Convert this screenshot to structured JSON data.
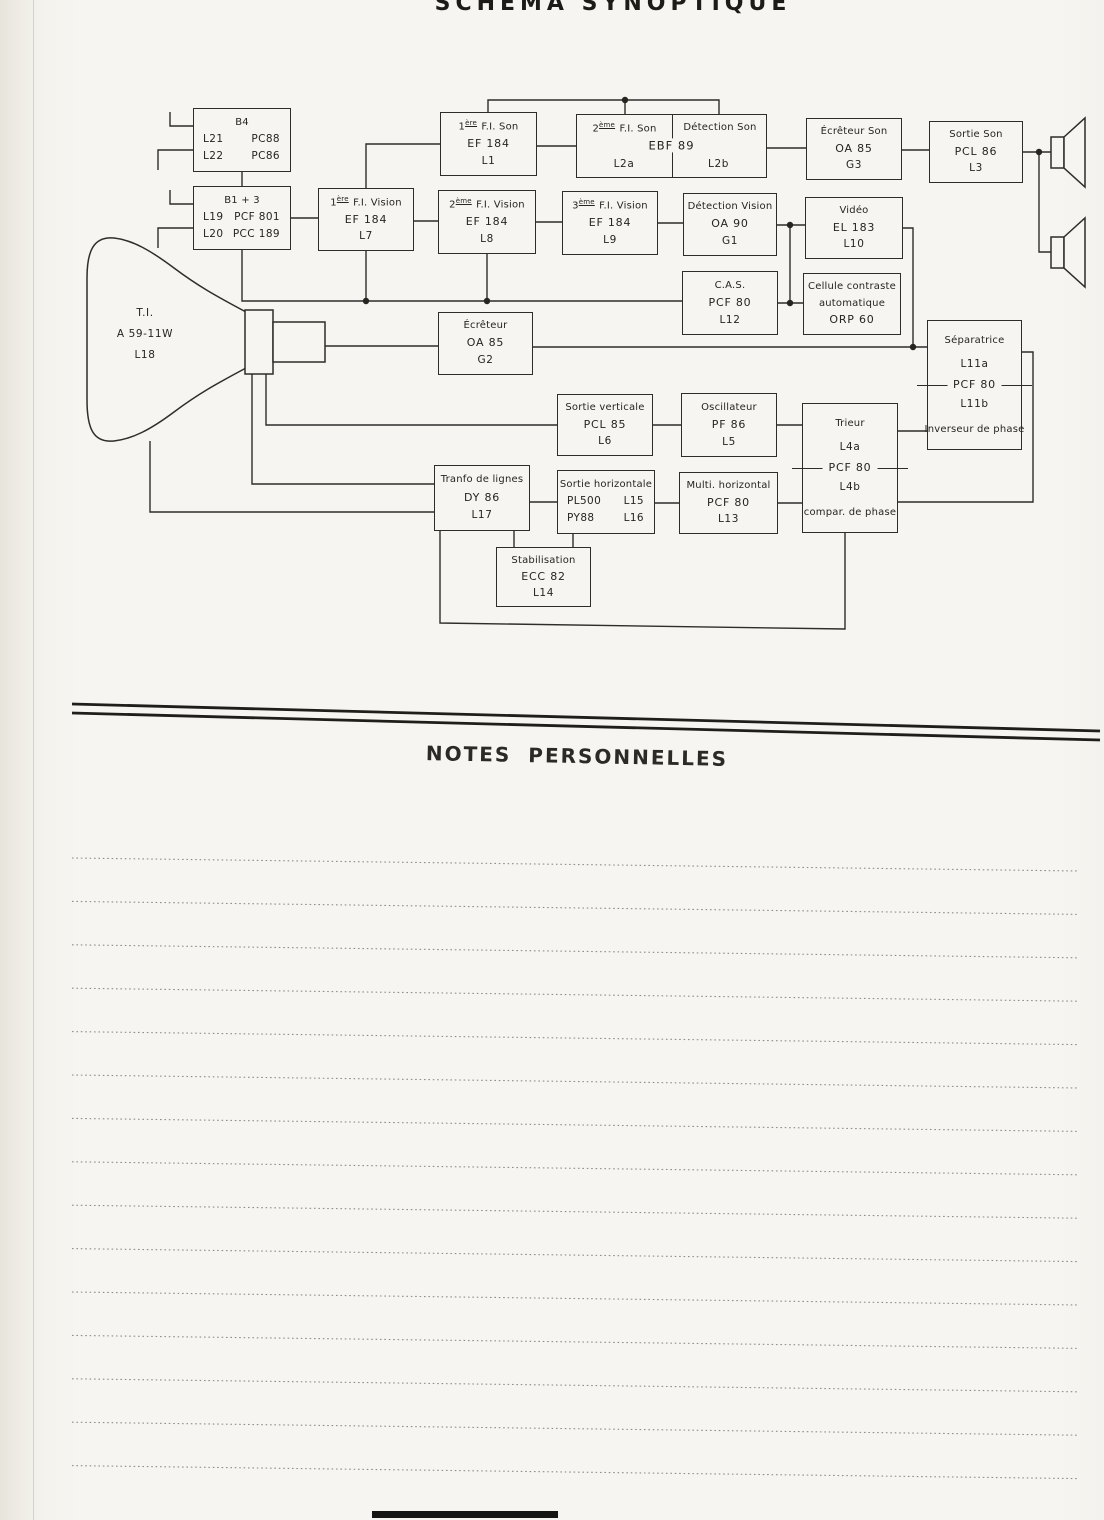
{
  "page": {
    "title": "SCHÉMA SYNOPTIQUE",
    "notes_heading": "NOTES PERSONNELLES"
  },
  "blocks": {
    "tuner_b4": {
      "title": "B4",
      "rows": [
        {
          "l": "L21",
          "r": "PC88"
        },
        {
          "l": "L22",
          "r": "PC86"
        }
      ]
    },
    "tuner_b1_3": {
      "title": "B1 + 3",
      "rows": [
        {
          "l": "L19",
          "r": "PCF 801"
        },
        {
          "l": "L20",
          "r": "PCC 189"
        }
      ]
    },
    "fi1_son": {
      "num": "1",
      "sup": "ère",
      "name": "F.I. Son",
      "tube": "EF 184",
      "ref": "L1"
    },
    "son_if_det": {
      "left_num": "2",
      "left_sup": "ème",
      "left_name": "F.I. Son",
      "right_name": "Détection Son",
      "tube": "EBF 89",
      "left_ref": "L2a",
      "right_ref": "L2b"
    },
    "ecreteur_son": {
      "name": "Écrêteur Son",
      "tube": "OA 85",
      "ref": "G3"
    },
    "sortie_son": {
      "name": "Sortie Son",
      "tube": "PCL 86",
      "ref": "L3"
    },
    "fi1_vision": {
      "num": "1",
      "sup": "ère",
      "name": "F.I. Vision",
      "tube": "EF 184",
      "ref": "L7"
    },
    "fi2_vision": {
      "num": "2",
      "sup": "ème",
      "name": "F.I. Vision",
      "tube": "EF 184",
      "ref": "L8"
    },
    "fi3_vision": {
      "num": "3",
      "sup": "ème",
      "name": "F.I. Vision",
      "tube": "EF 184",
      "ref": "L9"
    },
    "det_vision": {
      "name": "Détection Vision",
      "tube": "OA 90",
      "ref": "G1"
    },
    "video": {
      "name": "Vidéo",
      "tube": "EL 183",
      "ref": "L10"
    },
    "cas": {
      "name": "C.A.S.",
      "tube": "PCF 80",
      "ref": "L12"
    },
    "cellule": {
      "name1": "Cellule contraste",
      "name2": "automatique",
      "tube": "ORP 60"
    },
    "ecreteur": {
      "name": "Écrêteur",
      "tube": "OA 85",
      "ref": "G2"
    },
    "separatrice": {
      "top_name": "Séparatrice",
      "top_ref": "L11a",
      "tube": "PCF 80",
      "bottom_ref": "L11b",
      "bottom_name": "Inverseur de phase"
    },
    "sortie_verticale": {
      "name": "Sortie verticale",
      "tube": "PCL 85",
      "ref": "L6"
    },
    "oscillateur": {
      "name": "Oscillateur",
      "tube": "PF 86",
      "ref": "L5"
    },
    "trieur": {
      "top_name": "Trieur",
      "top_ref": "L4a",
      "tube": "PCF 80",
      "bottom_ref": "L4b",
      "bottom_name": "compar. de phase"
    },
    "transfo": {
      "name": "Tranfo de lignes",
      "tube": "DY 86",
      "ref": "L17"
    },
    "sortie_horizontale": {
      "name": "Sortie horizontale",
      "rows": [
        {
          "l": "PL500",
          "r": "L15"
        },
        {
          "l": "PY88",
          "r": "L16"
        }
      ]
    },
    "multi_horizontal": {
      "name": "Multi. horizontal",
      "tube": "PCF 80",
      "ref": "L13"
    },
    "stabilisation": {
      "name": "Stabilisation",
      "tube": "ECC 82",
      "ref": "L14"
    },
    "crt": {
      "line1": "T.I.",
      "line2": "A 59-11W",
      "line3": "L18"
    }
  }
}
